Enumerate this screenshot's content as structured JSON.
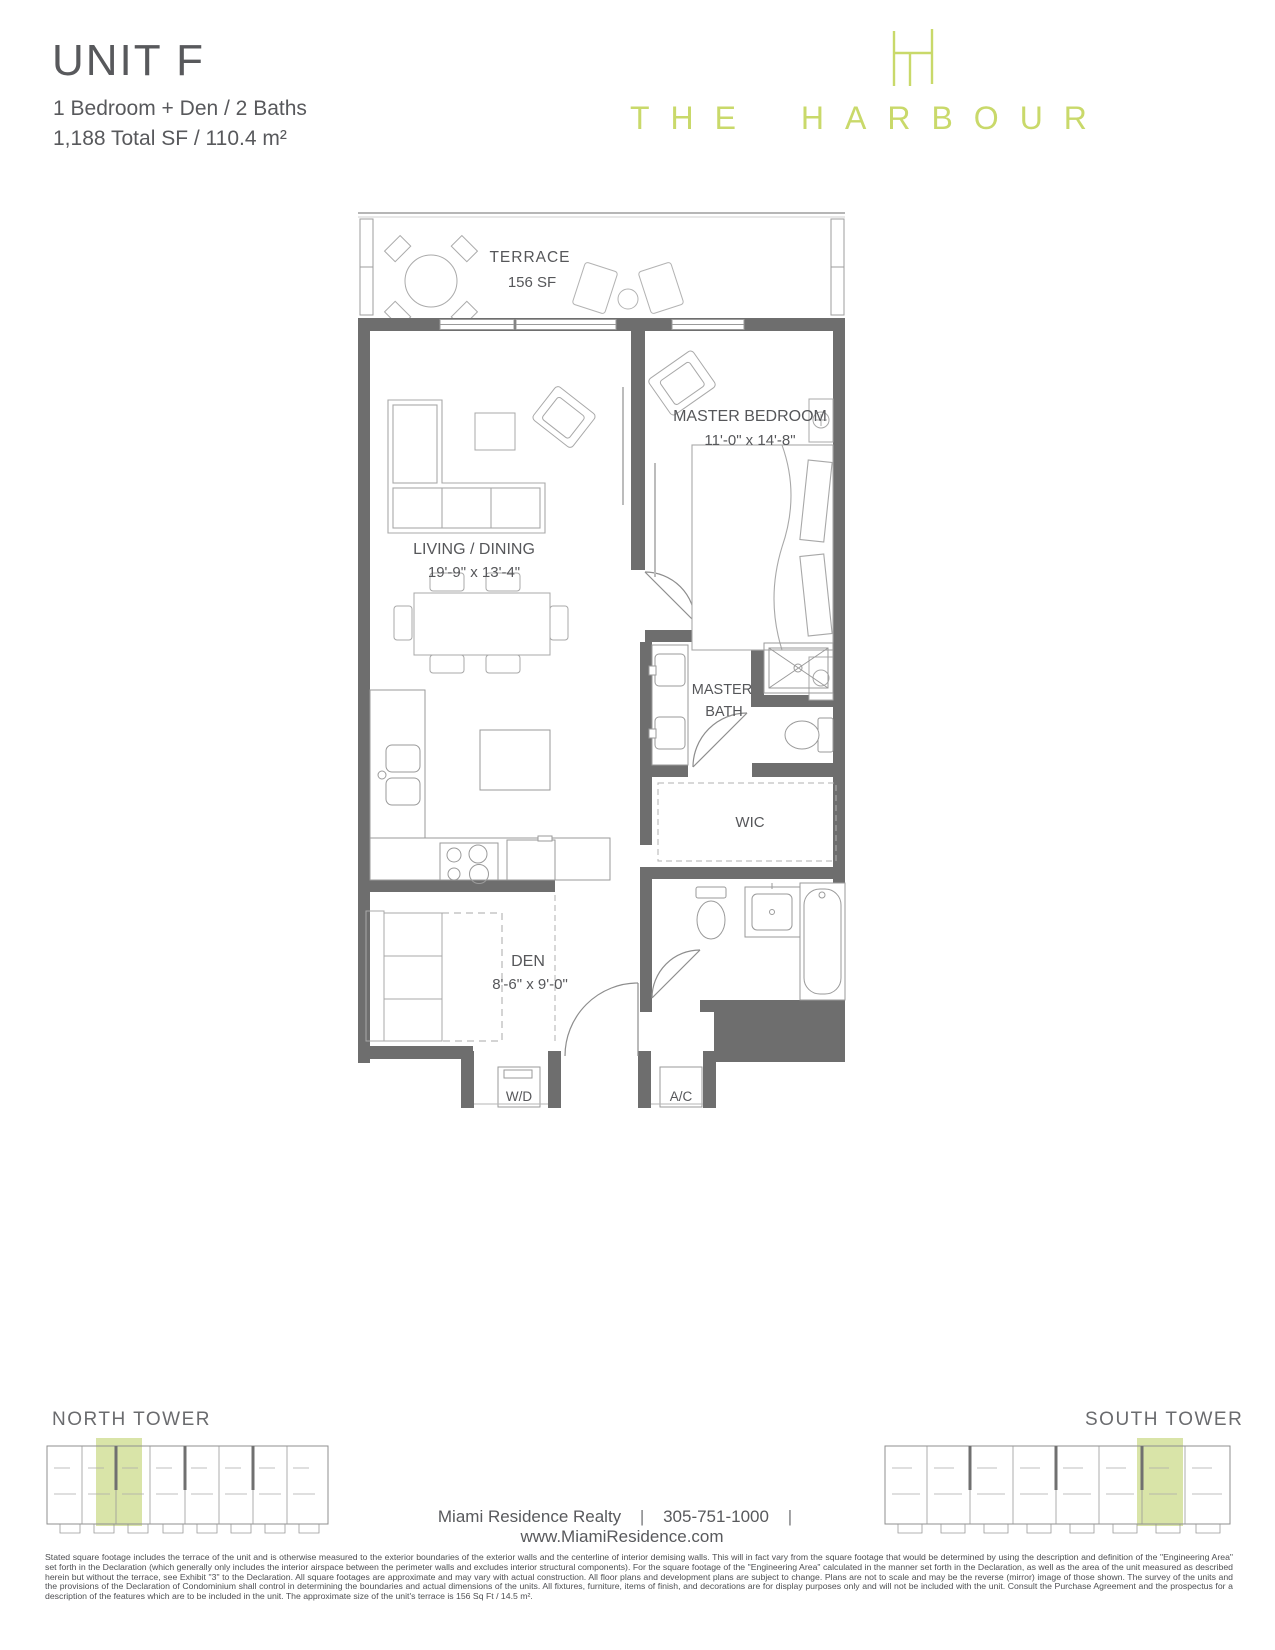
{
  "header": {
    "unit_title": "UNIT F",
    "subtitle_line1": "1 Bedroom + Den / 2 Baths",
    "subtitle_line2": "1,188 Total SF / 110.4 m²"
  },
  "logo": {
    "wordmark": "THE HARBOUR",
    "color": "#c9d96a"
  },
  "floorplan": {
    "wall_color": "#6e6e6e",
    "line_color": "#9a9a9a",
    "terrace_name": "TERRACE",
    "terrace_area": "156 SF",
    "living_name": "LIVING / DINING",
    "living_dims": "19'-9\" x 13'-4\"",
    "master_bedroom_name": "MASTER BEDROOM",
    "master_bedroom_dims": "11'-0\" x 14'-8\"",
    "master_bath_line1": "MASTER",
    "master_bath_line2": "BATH",
    "wic_label": "WIC",
    "den_name": "DEN",
    "den_dims": "8'-6\" x 9'-0\"",
    "washer_dryer_label": "W/D",
    "ac_label": "A/C"
  },
  "towers": {
    "north_label": "NORTH TOWER",
    "south_label": "SOUTH TOWER",
    "highlight_color": "#cfdd92"
  },
  "footer": {
    "realty": "Miami Residence Realty",
    "phone": "305-751-1000",
    "website": "www.MiamiResidence.com",
    "separator": "|",
    "disclaimer": "Stated square footage includes the terrace of the unit and is otherwise measured to the exterior boundaries of the exterior walls and the centerline of interior demising walls. This will in fact vary from the square footage that would be determined by using the description and definition of the \"Engineering Area\" set forth in the Declaration (which generally only includes the interior airspace between the perimeter walls and excludes interior structural components). For the square footage of the \"Engineering Area\" calculated in the manner set forth in the Declaration, as well as the area of the unit measured as described herein but without the terrace, see Exhibit \"3\" to the Declaration. All square footages are approximate and may vary with actual construction. All floor plans and development plans are subject to change. Plans are not to scale and may be the reverse (mirror) image of those shown. The survey of the units and the provisions of the Declaration of Condominium shall control in determining the boundaries and actual dimensions of the units. All fixtures, furniture, items of finish, and decorations are for display purposes only and will not be included with the unit. Consult the Purchase Agreement and the prospectus for a description of the features which are to be included in the unit. The approximate size of the unit's terrace is 156 Sq Ft / 14.5 m²."
  }
}
